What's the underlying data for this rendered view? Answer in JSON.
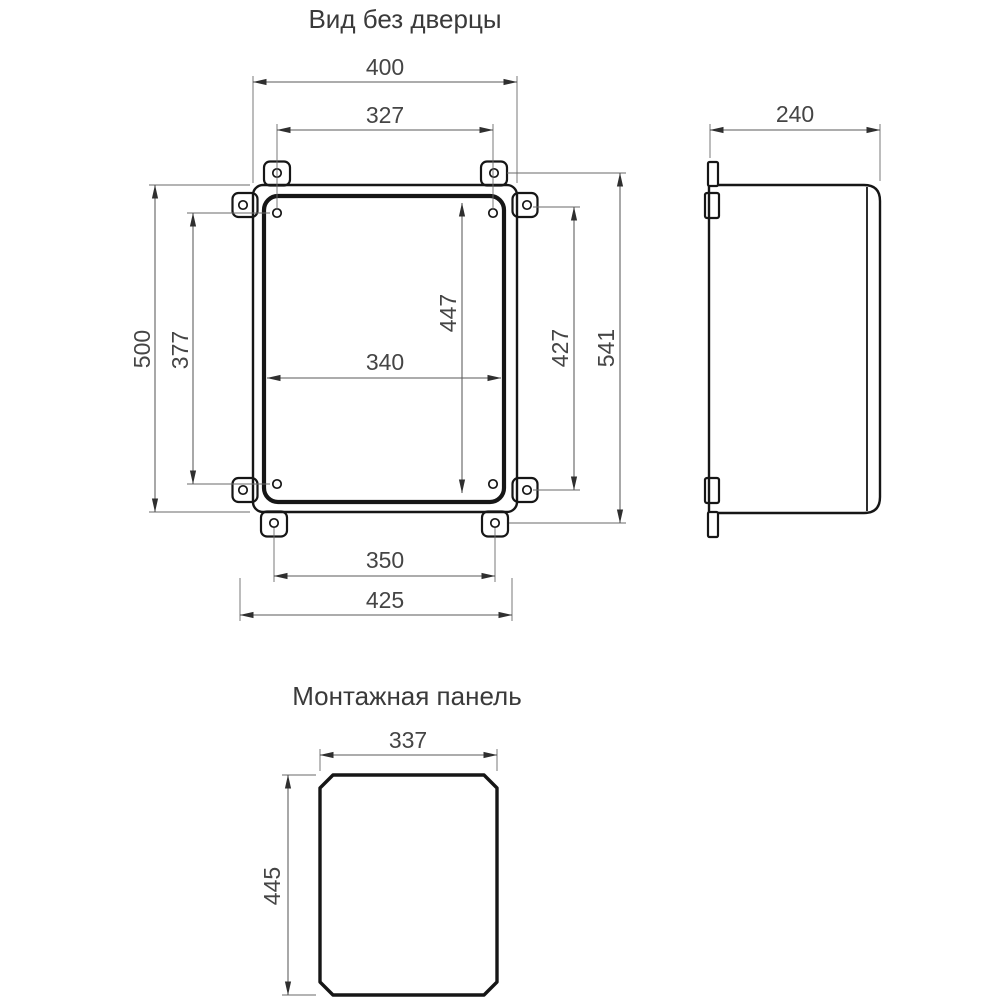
{
  "drawing": {
    "background": "#ffffff",
    "outline_color": "#161616",
    "dim_line_color": "#5a5a5a",
    "text_color": "#454545"
  },
  "front_view": {
    "title": "Вид без дверцы",
    "dims": {
      "box_width": "400",
      "top_holes_spacing": "327",
      "box_height": "500",
      "left_holes_spacing": "377",
      "panel_holes_vertical": "447",
      "panel_width": "340",
      "right_holes_spacing": "427",
      "overall_height": "541",
      "bottom_holes_spacing": "350",
      "overall_width": "425"
    }
  },
  "side_view": {
    "dims": {
      "depth": "240"
    }
  },
  "panel_view": {
    "title": "Монтажная панель",
    "dims": {
      "width": "337",
      "height": "445"
    }
  }
}
